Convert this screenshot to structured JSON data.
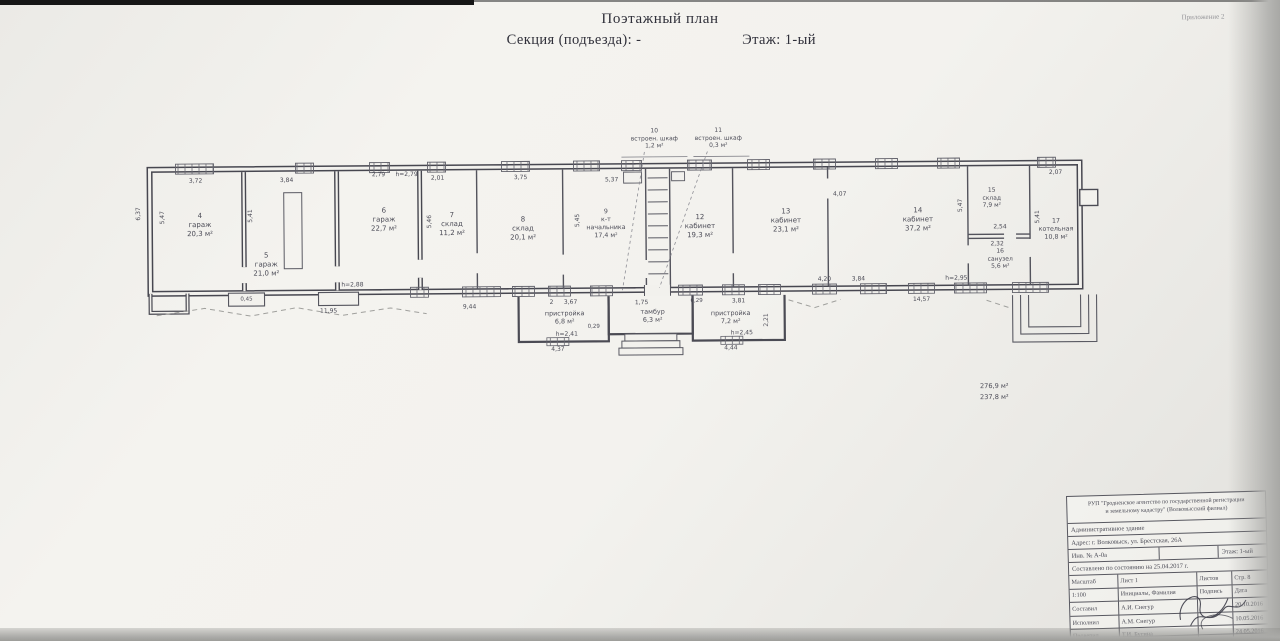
{
  "page": {
    "title": "Поэтажный план",
    "section_label": "Секция (подъезда): -",
    "floor_label": "Этаж: 1-ый",
    "corner_note": "Приложение 2"
  },
  "plan": {
    "labels": [
      {
        "name": "room-label-4",
        "text": "4\nгараж\n20,3 м²",
        "x": 200,
        "y": 222
      },
      {
        "name": "room-label-5",
        "text": "5\nгараж\n21,0 м²",
        "x": 266,
        "y": 262
      },
      {
        "name": "room-label-6",
        "text": "6\nгараж\n22,7 м²",
        "x": 384,
        "y": 218
      },
      {
        "name": "room-label-7",
        "text": "7\nсклад\n11,2 м²",
        "x": 452,
        "y": 223
      },
      {
        "name": "room-label-8",
        "text": "8\nсклад\n20,1 м²",
        "x": 523,
        "y": 228
      },
      {
        "name": "room-label-9",
        "text": "9\nк-т\nначальника\n17,4 м²",
        "x": 606,
        "y": 224,
        "fs": 6.3
      },
      {
        "name": "room-label-12",
        "text": "12\nкабинет\n19,3 м²",
        "x": 700,
        "y": 227
      },
      {
        "name": "room-label-13",
        "text": "13\nкабинет\n23,1 м²",
        "x": 786,
        "y": 222
      },
      {
        "name": "room-label-14",
        "text": "14\nкабинет\n37,2 м²",
        "x": 918,
        "y": 222
      },
      {
        "name": "room-label-15",
        "text": "15\nсклад\n7,9 м²",
        "x": 992,
        "y": 201,
        "fs": 6
      },
      {
        "name": "room-label-16",
        "text": "16\nсанузел\n5,6 м²",
        "x": 1000,
        "y": 262,
        "fs": 6
      },
      {
        "name": "room-label-17",
        "text": "17\nкотельная\n10,8 м²",
        "x": 1056,
        "y": 233,
        "fs": 6.3
      },
      {
        "name": "closet-label-10",
        "text": "10\nвстроен. шкаф\n1,2 м²",
        "x": 655,
        "y": 139,
        "fs": 6
      },
      {
        "name": "closet-label-11",
        "text": "11\nвстроен. шкаф\n0,3 м²",
        "x": 719,
        "y": 139,
        "fs": 6
      },
      {
        "name": "annex-label-2",
        "text": "пристройка\n6,8 м²",
        "x": 564,
        "y": 317,
        "fs": 6.4
      },
      {
        "name": "tambour-label",
        "text": "тамбур\n6,3 м²",
        "x": 652,
        "y": 316,
        "fs": 6.4
      },
      {
        "name": "annex-label-3",
        "text": "пристройка\n7,2 м²",
        "x": 730,
        "y": 318,
        "fs": 6.4
      },
      {
        "name": "total-area-label",
        "text": "276,9 м²",
        "x": 993,
        "y": 389,
        "fs": 6.6
      },
      {
        "name": "total-area-label",
        "text": "237,8 м²",
        "x": 993,
        "y": 400,
        "fs": 6.6
      },
      {
        "text": "3,72",
        "x": 196,
        "y": 178,
        "fs": 6
      },
      {
        "text": "3,84",
        "x": 287,
        "y": 178,
        "fs": 6
      },
      {
        "text": "2,79",
        "x": 379,
        "y": 173,
        "fs": 6
      },
      {
        "text": "h=2,79",
        "x": 407,
        "y": 173,
        "fs": 6
      },
      {
        "text": "2,01",
        "x": 438,
        "y": 177,
        "fs": 6
      },
      {
        "text": "3,75",
        "x": 521,
        "y": 177,
        "fs": 6
      },
      {
        "text": "5,37",
        "x": 612,
        "y": 180,
        "fs": 6
      },
      {
        "text": "4,07",
        "x": 840,
        "y": 196,
        "fs": 6
      },
      {
        "text": "2,07",
        "x": 1056,
        "y": 176,
        "fs": 6
      },
      {
        "text": "2,54",
        "x": 1000,
        "y": 230,
        "fs": 6
      },
      {
        "text": "2,32",
        "x": 997,
        "y": 247,
        "fs": 6
      },
      {
        "text": "6,37",
        "x": 139,
        "y": 210,
        "rot": -90,
        "fs": 6
      },
      {
        "text": "5,47",
        "x": 163,
        "y": 214,
        "rot": -90,
        "fs": 6
      },
      {
        "text": "5,41",
        "x": 251,
        "y": 213,
        "rot": -90,
        "fs": 6
      },
      {
        "text": "5,46",
        "x": 430,
        "y": 220,
        "rot": -90,
        "fs": 6
      },
      {
        "text": "5,45",
        "x": 578,
        "y": 220,
        "rot": -90,
        "fs": 6
      },
      {
        "text": "5,47",
        "x": 961,
        "y": 208,
        "rot": -90,
        "fs": 6
      },
      {
        "text": "5,41",
        "x": 1038,
        "y": 220,
        "rot": -90,
        "fs": 6
      },
      {
        "text": "2,21",
        "x": 766,
        "y": 321,
        "rot": -90,
        "fs": 6
      },
      {
        "text": "11,95",
        "x": 328,
        "y": 309,
        "fs": 6
      },
      {
        "text": "0,45",
        "x": 246,
        "y": 297,
        "fs": 5.5
      },
      {
        "text": "h=2,88",
        "x": 352,
        "y": 283,
        "fs": 6
      },
      {
        "text": "9,44",
        "x": 469,
        "y": 306,
        "fs": 6
      },
      {
        "text": "2",
        "x": 551,
        "y": 302,
        "fs": 6
      },
      {
        "text": "3,67",
        "x": 570,
        "y": 302,
        "fs": 6
      },
      {
        "text": "h=2,41",
        "x": 566,
        "y": 334,
        "fs": 6
      },
      {
        "text": "4,37",
        "x": 557,
        "y": 349,
        "fs": 6
      },
      {
        "text": "0,29",
        "x": 593,
        "y": 327,
        "fs": 5.5
      },
      {
        "text": "1,75",
        "x": 641,
        "y": 303,
        "fs": 6
      },
      {
        "text": "0,29",
        "x": 696,
        "y": 302,
        "fs": 5.5
      },
      {
        "text": "3,81",
        "x": 738,
        "y": 302,
        "fs": 6
      },
      {
        "text": "h=2,45",
        "x": 741,
        "y": 334,
        "fs": 6
      },
      {
        "text": "4,44",
        "x": 730,
        "y": 349,
        "fs": 6
      },
      {
        "text": "4,20",
        "x": 824,
        "y": 281,
        "fs": 6
      },
      {
        "text": "3,84",
        "x": 858,
        "y": 281,
        "fs": 6
      },
      {
        "text": "h=2,95",
        "x": 956,
        "y": 281,
        "fs": 6
      },
      {
        "text": "14,57",
        "x": 921,
        "y": 302,
        "fs": 6
      }
    ]
  },
  "stamp": {
    "org_line1": "РУП \"Гродненское агентство по государственной регистрации",
    "org_line2": "и земельному кадастру\" (Волковысский филиал)",
    "building": "Административное здание",
    "address": "Адрес: г. Волковыск, ул. Брестская, 26А",
    "inventory_label": "Инв. № А-0а",
    "inventory_value": "",
    "floor": "Этаж: 1-ый",
    "compiled": "Составлено по состоянию на 25.04.2017 г.",
    "scale_label": "Масштаб",
    "sheet_label": "Лист 1",
    "sheets_label": "Листов",
    "page_label": "Стр. 8",
    "scale_value": "1:100",
    "names_header": "Инициалы, Фамилия",
    "sign_header": "Подпись",
    "date_header": "Дата",
    "rows": [
      {
        "role": "Составил",
        "name": "А.И. Снегур",
        "date": "20.10.2016"
      },
      {
        "role": "Исполнил",
        "name": "А.М. Снегур",
        "date": "10.05.2016"
      },
      {
        "role": "Проверил",
        "name": "Т.И. Бусина",
        "date": "24.05.2016"
      }
    ]
  }
}
